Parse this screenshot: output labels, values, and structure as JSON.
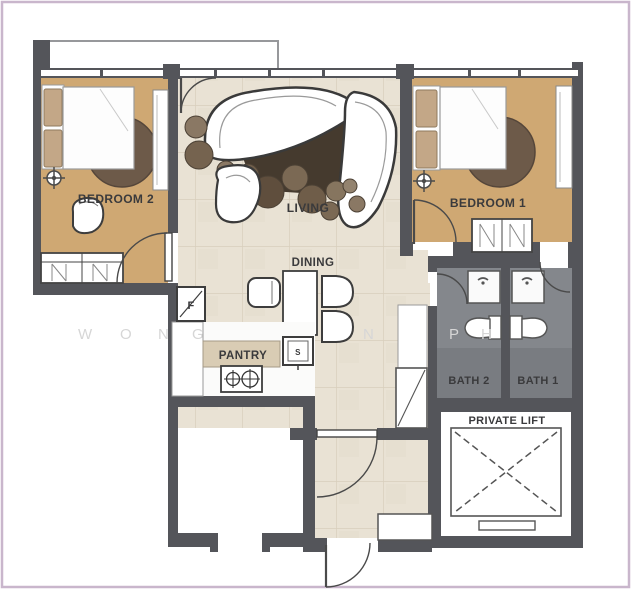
{
  "plan": {
    "title": "2-bedroom unit floor plan",
    "rooms": {
      "bedroom2": "BEDROOM 2",
      "bedroom1": "BEDROOM 1",
      "living": "LIVING",
      "dining": "DINING",
      "pantry": "PANTRY",
      "bath2": "BATH 2",
      "bath1": "BATH 1",
      "lift": "PRIVATE LIFT"
    },
    "appliances": {
      "fridge": "F",
      "sink": "S"
    },
    "watermark": {
      "letters": [
        "W",
        "O",
        "N",
        "G",
        "N",
        "P",
        "H"
      ]
    },
    "colors": {
      "wall": "#54555a",
      "wood_floor": "#cfa873",
      "tile_floor": "#e9e2d4",
      "bath_floor": "#84878c",
      "frame": "#c9b6cc",
      "rug": "#6d5a49"
    }
  }
}
